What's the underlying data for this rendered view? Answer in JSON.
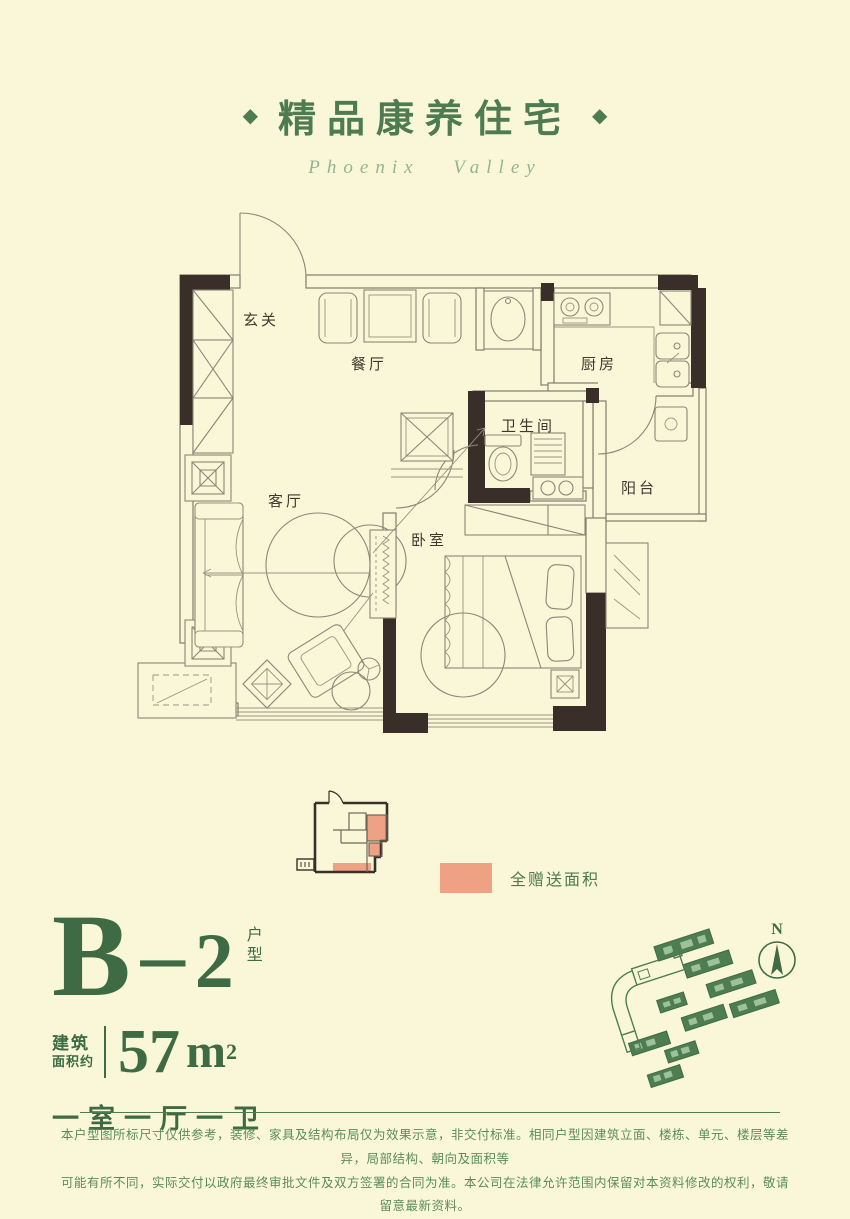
{
  "header": {
    "diamond_left": "◆",
    "title": "精品康养住宅",
    "diamond_right": "◆",
    "subtitle": "Phoenix Valley"
  },
  "floorplan": {
    "rooms": {
      "entry": "玄关",
      "dining": "餐厅",
      "kitchen": "厨房",
      "bathroom": "卫生间",
      "balcony": "阳台",
      "living": "客厅",
      "bedroom": "卧室"
    }
  },
  "keyplan": {
    "legend_label": "全赠送面积",
    "highlight_color": "#EFA183"
  },
  "unit_info": {
    "type_letter": "B",
    "type_separator": "－",
    "type_number": "2",
    "type_label_vertical": "户型",
    "area_label_line1": "建筑",
    "area_label_line2": "面积约",
    "area_value": "57",
    "area_unit": "m",
    "area_exponent": "2",
    "layout_text": "一室一厅一卫"
  },
  "siteplan": {
    "north_label": "N"
  },
  "disclaimer": {
    "line1": "本户型图所标尺寸仅供参考，装修、家具及结构布局仅为效果示意，非交付标准。相同户型因建筑立面、楼栋、单元、楼层等差异，局部结构、朝向及面积等",
    "line2": "可能有所不同，实际交付以政府最终审批文件及双方签署的合同为准。本公司在法律允许范围内保留对本资料修改的权利，敬请留意最新资料。"
  },
  "colors": {
    "background": "#FAF7D8",
    "brand_green": "#4E7B51",
    "dark_green": "#3E6B44",
    "wall_dark": "#3A2F28",
    "gift_orange": "#EFA183"
  }
}
